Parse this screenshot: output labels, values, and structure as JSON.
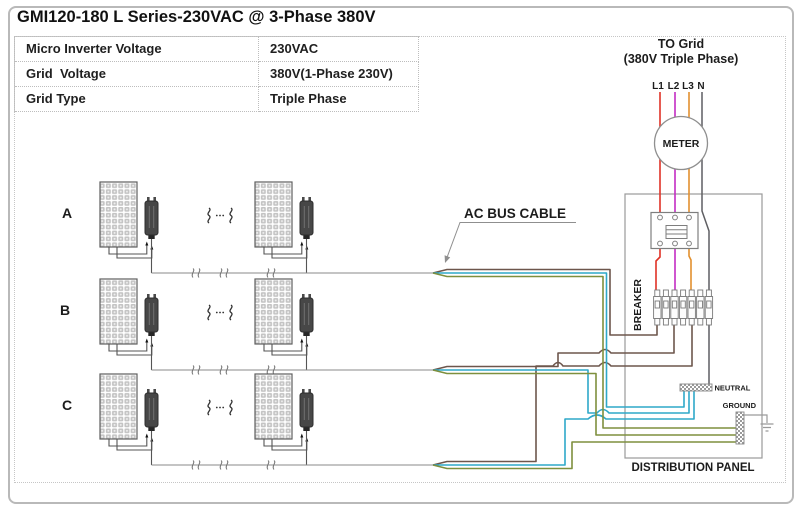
{
  "title": "GMI120-180 L Series-230VAC @ 3-Phase 380V",
  "spec_table": {
    "rows": [
      {
        "label": "Micro Inverter Voltage",
        "value": "230VAC"
      },
      {
        "label": "Grid  Voltage",
        "value": "380V(1-Phase 230V)"
      },
      {
        "label": "Grid Type",
        "value": "Triple Phase"
      }
    ]
  },
  "grid": {
    "to_line1": "TO Grid",
    "to_line2": "(380V Triple Phase)",
    "phases": [
      "L1",
      "L2",
      "L3",
      "N"
    ]
  },
  "meter": {
    "label": "METER"
  },
  "ac_bus": {
    "label": "AC BUS CABLE"
  },
  "distribution_panel": {
    "label": "DISTRIBUTION PANEL",
    "breaker_label": "BREAKER",
    "neutral_label": "NEUTRAL",
    "ground_label": "GROUND"
  },
  "array_rows": [
    {
      "label": "A"
    },
    {
      "label": "B"
    },
    {
      "label": "C"
    }
  ],
  "colors": {
    "l1_red": "#e03226",
    "l2_magenta": "#c32bc3",
    "l3_orange": "#e2902f",
    "neutral_wire": "#5f5f63",
    "ac_line_brown": "#6d564c",
    "ac_neutral_blue": "#2ea8c9",
    "ac_ground_green": "#7e8f3e"
  }
}
